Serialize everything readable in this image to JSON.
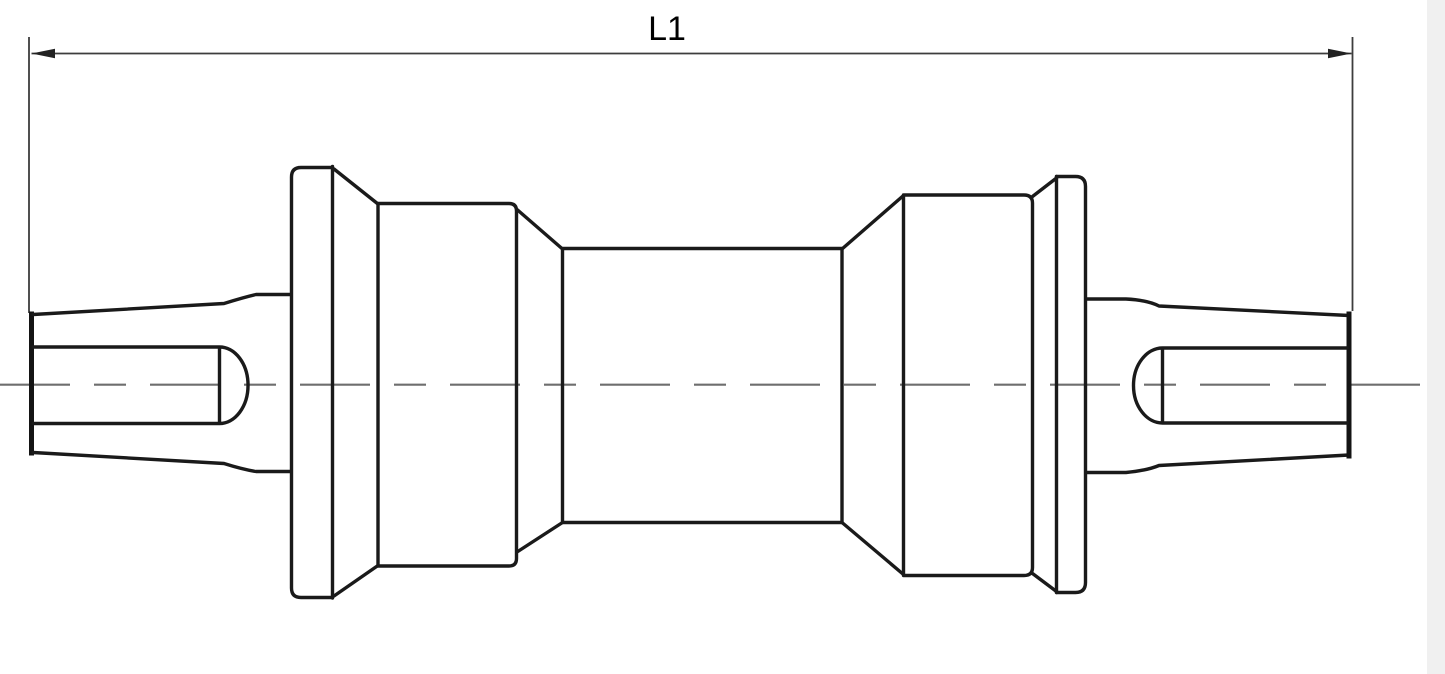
{
  "page": {
    "background_color": "#ffffff",
    "right_gutter_color": "#f0f0f0"
  },
  "drawing": {
    "dimension": {
      "label": "L1"
    },
    "colors": {
      "outline": "#1a1a1a",
      "centerline": "#6e6e6e",
      "dimension_line": "#3d3d3d",
      "label_text": "#000000"
    }
  }
}
